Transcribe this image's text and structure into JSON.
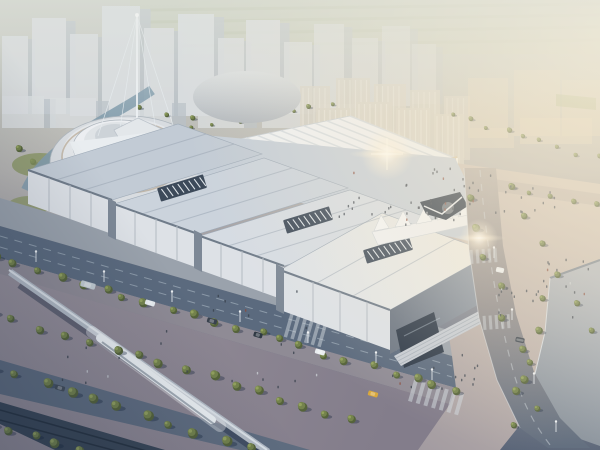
{
  "scene": {
    "title": "Exhibition Center Aerial Rendering",
    "description": "Photorealistic architectural aerial rendering of a large white exhibition center complex with stepped folded-plate roofs and dark roof louvers, a long ribbed barrel-roof hall, a wavy white entrance canopy with a dark angular entry, a cable-stayed mast, a round spiral cultural building and dome beside a canal, a warm sunlit plaza with crowds, tree-lined boulevards with cars and street lamps, an elevated monorail guideway with a passing blurred train, and a hazy high-rise city skyline under warm sunset light from the upper right.",
    "time_of_day": "hazy late-afternoon sun from upper right",
    "style": "CGI architectural visualization, no visible text"
  },
  "palette": {
    "haze_warm": "#f3e8cf",
    "field_green": "#c7cbb8",
    "city_light": "#d8dcdf",
    "city_shade": "#b9c0c7",
    "ribbed_roof": "#eff1f3",
    "roof_pale": "#c2cbd5",
    "roof_bright": "#e6e8e6",
    "wall_light": "#dde1e6",
    "wall_shadow": "#707c8a",
    "glass_dark": "#2c3848",
    "plaza_warm": "#c8bdb5",
    "road_dark": "#5b6a7e",
    "pedestrian_mauve": "#918c97",
    "tree_green": "#74834c",
    "tree_shadow": "#4d5b33",
    "water_blue": "#849dad",
    "monorail_beam": "#b4bcc6",
    "train_white": "#eef2f5",
    "flare_white": "#fff7e8",
    "accent_wood": "#d8c8a9",
    "car_yellow": "#d9a83c"
  },
  "decor": {
    "towers": [
      [
        2,
        36,
        26,
        78,
        0.85
      ],
      [
        32,
        18,
        34,
        96,
        0.9
      ],
      [
        70,
        34,
        28,
        82,
        0.85
      ],
      [
        102,
        6,
        38,
        112,
        0.95
      ],
      [
        144,
        28,
        30,
        88,
        0.9
      ],
      [
        178,
        14,
        36,
        102,
        0.95
      ],
      [
        218,
        38,
        26,
        76,
        0.85
      ],
      [
        246,
        20,
        34,
        94,
        0.9
      ],
      [
        284,
        42,
        28,
        72,
        0.8
      ],
      [
        314,
        24,
        30,
        88,
        0.75
      ],
      [
        352,
        38,
        26,
        70,
        0.65
      ],
      [
        382,
        26,
        28,
        80,
        0.6
      ],
      [
        412,
        44,
        24,
        60,
        0.5
      ],
      [
        2,
        96,
        42,
        32,
        0.8
      ],
      [
        50,
        98,
        46,
        30,
        0.8
      ],
      [
        122,
        100,
        50,
        28,
        0.8
      ],
      [
        198,
        102,
        46,
        26,
        0.78
      ],
      [
        262,
        102,
        42,
        26,
        0.72
      ],
      [
        318,
        104,
        40,
        24,
        0.55
      ]
    ],
    "slabs": [
      [
        300,
        86,
        30,
        72,
        0.75
      ],
      [
        336,
        78,
        34,
        82,
        0.8
      ],
      [
        374,
        84,
        32,
        78,
        0.8
      ],
      [
        410,
        90,
        30,
        72,
        0.75
      ],
      [
        444,
        96,
        26,
        64,
        0.65
      ],
      [
        316,
        108,
        34,
        74,
        0.88
      ],
      [
        356,
        102,
        36,
        80,
        0.9
      ],
      [
        396,
        108,
        34,
        74,
        0.88
      ],
      [
        434,
        114,
        30,
        66,
        0.8
      ]
    ],
    "haze_blocks": [
      [
        468,
        78,
        40,
        60,
        0.5
      ],
      [
        514,
        70,
        46,
        66,
        0.5
      ],
      [
        562,
        80,
        38,
        56,
        0.45
      ],
      [
        520,
        118,
        72,
        26,
        0.5
      ],
      [
        470,
        128,
        44,
        20,
        0.45
      ]
    ],
    "tree_rows": [
      {
        "x1": -8,
        "y1": 258,
        "x2": 460,
        "y2": 392,
        "n": 22,
        "s": 1.05,
        "l": "fg"
      },
      {
        "x1": -8,
        "y1": 314,
        "x2": 355,
        "y2": 420,
        "n": 16,
        "s": 1.15,
        "l": "fg"
      },
      {
        "x1": -8,
        "y1": 368,
        "x2": 250,
        "y2": 448,
        "n": 11,
        "s": 1.2,
        "l": "fg"
      },
      {
        "x1": -8,
        "y1": 424,
        "x2": 100,
        "y2": 456,
        "n": 6,
        "s": 1.1,
        "l": "fg"
      },
      {
        "x1": 466,
        "y1": 196,
        "x2": 538,
        "y2": 408,
        "n": 8,
        "s": 0.95,
        "l": "fg"
      },
      {
        "x1": 546,
        "y1": 300,
        "x2": 512,
        "y2": 424,
        "n": 5,
        "s": 0.95,
        "l": "fg"
      },
      {
        "x1": 512,
        "y1": 186,
        "x2": 592,
        "y2": 332,
        "n": 6,
        "s": 0.8,
        "l": "fg"
      },
      {
        "x1": 334,
        "y1": 146,
        "x2": 596,
        "y2": 206,
        "n": 13,
        "s": 0.7,
        "l": "mid"
      },
      {
        "x1": 196,
        "y1": 126,
        "x2": 334,
        "y2": 104,
        "n": 8,
        "s": 0.55,
        "l": "bg"
      },
      {
        "x1": 16,
        "y1": 150,
        "x2": 120,
        "y2": 208,
        "n": 7,
        "s": 0.8,
        "l": "bg"
      },
      {
        "x1": 452,
        "y1": 116,
        "x2": 596,
        "y2": 158,
        "n": 9,
        "s": 0.6,
        "l": "bg"
      },
      {
        "x1": 140,
        "y1": 108,
        "x2": 190,
        "y2": 120,
        "n": 3,
        "s": 0.6,
        "l": "bg"
      }
    ],
    "crowds": [
      {
        "x": 338,
        "y": 166,
        "w": 225,
        "h": 50,
        "n": 40
      },
      {
        "x": 384,
        "y": 196,
        "w": 92,
        "h": 28,
        "n": 20
      },
      {
        "x": 492,
        "y": 282,
        "w": 96,
        "h": 38,
        "n": 18
      },
      {
        "x": 538,
        "y": 258,
        "w": 52,
        "h": 26,
        "n": 9
      },
      {
        "x": 372,
        "y": 348,
        "w": 110,
        "h": 40,
        "n": 14
      },
      {
        "x": 60,
        "y": 320,
        "w": 260,
        "h": 70,
        "n": 18
      },
      {
        "x": 210,
        "y": 290,
        "w": 110,
        "h": 40,
        "n": 8
      }
    ],
    "lamps": [
      [
        36,
        262
      ],
      [
        104,
        282
      ],
      [
        172,
        302
      ],
      [
        240,
        322
      ],
      [
        308,
        343
      ],
      [
        376,
        363
      ],
      [
        432,
        380
      ],
      [
        494,
        258
      ],
      [
        512,
        320
      ],
      [
        534,
        384
      ],
      [
        556,
        432
      ]
    ],
    "cars": [
      {
        "x": 88,
        "y": 285,
        "w": 15,
        "h": 6,
        "r": 16,
        "c": "#c3ccd2"
      },
      {
        "x": 150,
        "y": 303,
        "w": 10,
        "h": 5,
        "r": 16,
        "c": "#e9edf0"
      },
      {
        "x": 212,
        "y": 321,
        "w": 10,
        "h": 5,
        "r": 16,
        "c": "#39424e"
      },
      {
        "x": 258,
        "y": 335,
        "w": 9,
        "h": 5,
        "r": 16,
        "c": "#2f3944"
      },
      {
        "x": 320,
        "y": 352,
        "w": 10,
        "h": 5,
        "r": 16,
        "c": "#e9edf0"
      },
      {
        "x": 373,
        "y": 394,
        "w": 10,
        "h": 5,
        "r": 16,
        "c": "#d9a83c"
      },
      {
        "x": 520,
        "y": 340,
        "w": 5,
        "h": 9,
        "r": -78,
        "c": "#39424e"
      },
      {
        "x": 500,
        "y": 270,
        "w": 5,
        "h": 8,
        "r": -78,
        "c": "#e9edf0"
      },
      {
        "x": 60,
        "y": 388,
        "w": 10,
        "h": 5,
        "r": 16,
        "c": "#434d59"
      }
    ],
    "louvers": [
      [
        182,
        188
      ],
      [
        308,
        220
      ],
      [
        388,
        250
      ]
    ],
    "ribs": {
      "x": 188,
      "y": 150,
      "ux": 162,
      "uy": -34,
      "vx": 105,
      "vy": 42,
      "n": 14
    }
  }
}
